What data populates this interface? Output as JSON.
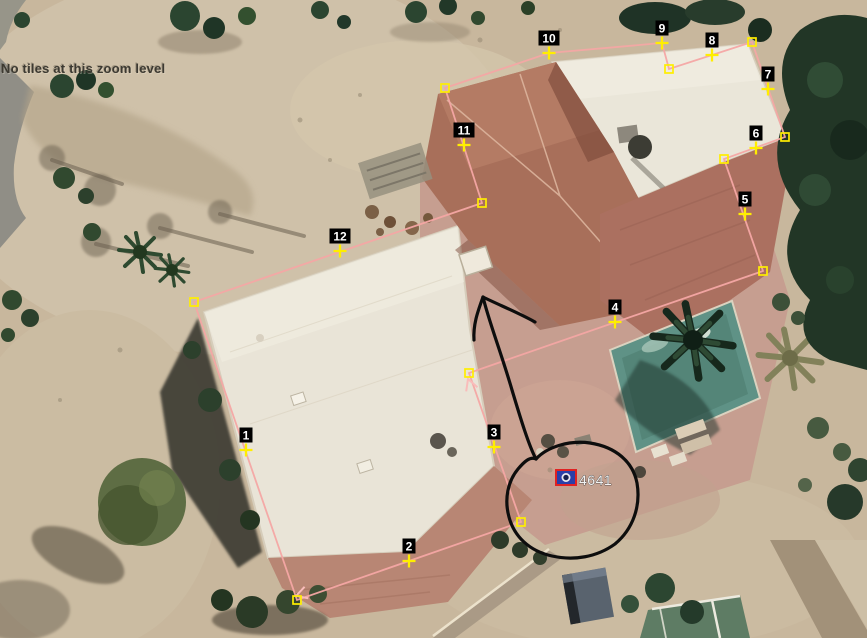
{
  "status": {
    "message": "No tiles at this zoom level"
  },
  "boundary": {
    "line_color": "#f4a6a4",
    "arrow_color": "#f9bcba",
    "marker_color": "#ffee00",
    "label_bg": "#000000",
    "label_fg": "#ffffff",
    "points": [
      [
        194,
        302
      ],
      [
        297,
        600
      ],
      [
        521,
        522
      ],
      [
        469,
        373
      ],
      [
        763,
        271
      ],
      [
        724,
        159
      ],
      [
        785,
        137
      ],
      [
        752,
        42
      ],
      [
        669,
        69
      ],
      [
        662,
        43
      ],
      [
        549,
        53
      ],
      [
        445,
        88
      ],
      [
        482,
        203
      ]
    ],
    "vertex_squares": [
      [
        194,
        302
      ],
      [
        297,
        600
      ],
      [
        521,
        522
      ],
      [
        469,
        373
      ],
      [
        763,
        271
      ],
      [
        724,
        159
      ],
      [
        785,
        137
      ],
      [
        752,
        42
      ],
      [
        669,
        69
      ],
      [
        445,
        88
      ],
      [
        482,
        203
      ]
    ],
    "numbered_markers": [
      {
        "label": "1",
        "x": 246,
        "y": 450
      },
      {
        "label": "2",
        "x": 409,
        "y": 561
      },
      {
        "label": "3",
        "x": 494,
        "y": 447
      },
      {
        "label": "4",
        "x": 615,
        "y": 322
      },
      {
        "label": "5",
        "x": 745,
        "y": 214
      },
      {
        "label": "6",
        "x": 756,
        "y": 148
      },
      {
        "label": "7",
        "x": 768,
        "y": 89
      },
      {
        "label": "8",
        "x": 712,
        "y": 55
      },
      {
        "label": "9",
        "x": 662,
        "y": 43
      },
      {
        "label": "10",
        "x": 549,
        "y": 53
      },
      {
        "label": "11",
        "x": 464,
        "y": 145
      },
      {
        "label": "12",
        "x": 340,
        "y": 251
      }
    ],
    "direction_arrows": [
      {
        "tip": [
          296,
          596
        ],
        "from": [
          521,
          522
        ]
      },
      {
        "tip": [
          468,
          379
        ],
        "from": [
          521,
          522
        ]
      }
    ]
  },
  "parcel_marker": {
    "label": "4641",
    "text_color": "#f2f2f2",
    "text_x": 579,
    "text_y": 485,
    "icon": {
      "x": 556,
      "y": 470,
      "w": 20,
      "h": 15,
      "border": "#e02222",
      "fill": "#2b3fa8",
      "glyph": "#e8e8f0"
    }
  },
  "freehand_annotation": {
    "color": "#0d0d0d",
    "strokes": {
      "arrow_shaft": "M483,297 C489,322 501,352 512,390 C521,420 529,446 536,459",
      "arrow_barb_left": "M483,297 C478,311 473,324 474,340",
      "arrow_barb_right": "M483,297 C499,305 517,312 535,322",
      "circle_loop": "M536,459 C547,447 569,440 590,443 C616,447 633,462 637,483 C641,506 633,529 615,544 C597,557 574,561 552,556 C529,551 514,536 509,517 C504,499 508,481 518,469 C524,462 530,456 536,459"
    }
  },
  "photo_palette": {
    "dirt": "#c8b79d",
    "road": "#908e86",
    "flat_roof": "#e9e4d7",
    "tile_roof": "#a86f5a",
    "pavers": "#c69e90",
    "pool": "#5f9286",
    "court": "#5e7c64",
    "trees_dark": "#223626"
  }
}
